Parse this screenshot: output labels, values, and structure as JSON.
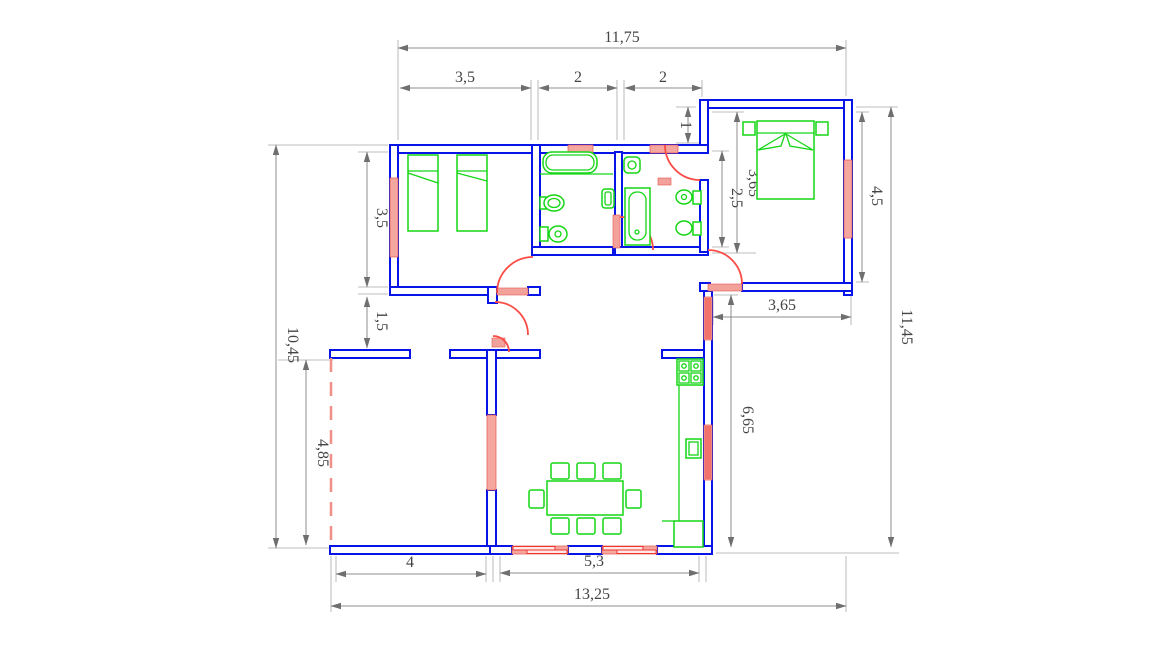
{
  "drawing": {
    "type": "architectural-floor-plan",
    "dims": {
      "top_overall": "11,75",
      "top_b1": "3,5",
      "top_bath1": "2",
      "top_bath2": "2",
      "b2_stub": "1",
      "b2_inner_h": "3,65",
      "b2_inner_h2": "2,5",
      "b2_right_h": "4,5",
      "right_overall": "11,45",
      "b1_left_h": "3,5",
      "hall_h": "1,5",
      "left_overall": "10,45",
      "left_room_h": "4,85",
      "right_mid_w": "3,65",
      "right_low_h": "6,65",
      "bottom_left_w": "4",
      "bottom_living_w": "5,3",
      "bottom_overall": "13,25"
    },
    "colors": {
      "wall": "#0614e8",
      "window_fill": "#f5a79f",
      "window_stripe": "#f0342c",
      "door": "#fb4b45",
      "furniture": "#15d615",
      "dimension_line": "#8c8c8c",
      "dimension_text": "#454545",
      "background": "#ffffff"
    }
  }
}
